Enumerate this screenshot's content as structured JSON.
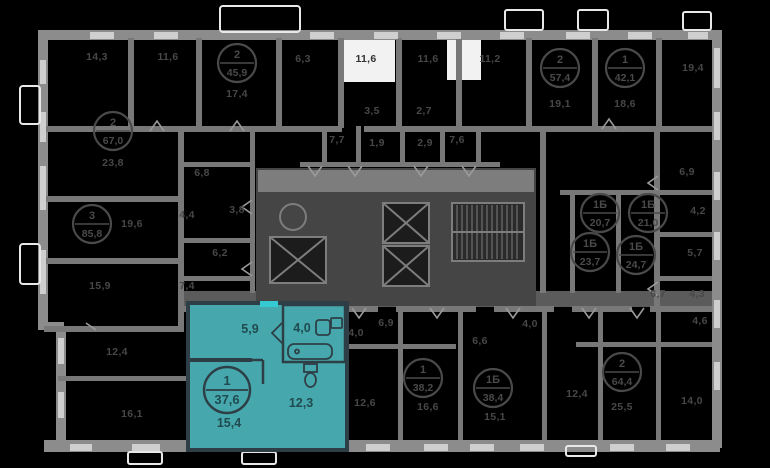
{
  "plan": {
    "colors": {
      "background": "#000000",
      "wall": "#8c8c8c",
      "window": "#cfcfcf",
      "corridor": "#5b5b5b",
      "core": "#454545",
      "white_room": "#f2f2f2",
      "dim_label": "#474747",
      "highlight_fill": "#46a8ac",
      "highlight_wall": "#2e3e46",
      "highlight_text": "#1f4b50",
      "entrance_mark": "#35c9d1"
    },
    "highlight": {
      "badge_rooms": "1",
      "badge_area": "37,6",
      "hall_area": "5,9",
      "bath_area": "4,0",
      "living_area": "15,4",
      "kitchen_area": "12,3"
    },
    "units": [
      {
        "rooms": "2",
        "area": "45,9",
        "x": 237,
        "y": 63
      },
      {
        "rooms": "2",
        "area": "67,0",
        "x": 113,
        "y": 131
      },
      {
        "rooms": "3",
        "area": "85,8",
        "x": 92,
        "y": 224
      },
      {
        "rooms": "2",
        "area": "57,4",
        "x": 560,
        "y": 68
      },
      {
        "rooms": "1",
        "area": "42,1",
        "x": 625,
        "y": 68
      },
      {
        "rooms": "1Б",
        "area": "20,7",
        "x": 600,
        "y": 213
      },
      {
        "rooms": "1Б",
        "area": "21,0",
        "x": 648,
        "y": 213
      },
      {
        "rooms": "1Б",
        "area": "23,7",
        "x": 590,
        "y": 252
      },
      {
        "rooms": "1Б",
        "area": "24,7",
        "x": 636,
        "y": 255
      },
      {
        "rooms": "1",
        "area": "38,2",
        "x": 423,
        "y": 378
      },
      {
        "rooms": "1Б",
        "area": "38,4",
        "x": 493,
        "y": 388
      },
      {
        "rooms": "2",
        "area": "64,4",
        "x": 622,
        "y": 372
      }
    ],
    "room_labels": [
      {
        "text": "14,3",
        "x": 97,
        "y": 60,
        "variant": "dim"
      },
      {
        "text": "11,6",
        "x": 168,
        "y": 60,
        "variant": "dim"
      },
      {
        "text": "17,4",
        "x": 237,
        "y": 97,
        "variant": "dim"
      },
      {
        "text": "6,3",
        "x": 303,
        "y": 62,
        "variant": "dim"
      },
      {
        "text": "11,6",
        "x": 366,
        "y": 62,
        "variant": "white"
      },
      {
        "text": "11,6",
        "x": 428,
        "y": 62,
        "variant": "dim"
      },
      {
        "text": "11,2",
        "x": 490,
        "y": 62,
        "variant": "dim"
      },
      {
        "text": "19,1",
        "x": 560,
        "y": 107,
        "variant": "dim"
      },
      {
        "text": "18,6",
        "x": 625,
        "y": 107,
        "variant": "dim"
      },
      {
        "text": "19,4",
        "x": 693,
        "y": 71,
        "variant": "dim"
      },
      {
        "text": "23,8",
        "x": 113,
        "y": 166,
        "variant": "dim"
      },
      {
        "text": "6,8",
        "x": 202,
        "y": 176,
        "variant": "dim"
      },
      {
        "text": "19,6",
        "x": 132,
        "y": 227,
        "variant": "dim"
      },
      {
        "text": "4,4",
        "x": 187,
        "y": 218,
        "variant": "dim"
      },
      {
        "text": "3,8",
        "x": 237,
        "y": 213,
        "variant": "dim"
      },
      {
        "text": "6,2",
        "x": 220,
        "y": 256,
        "variant": "dim"
      },
      {
        "text": "15,9",
        "x": 100,
        "y": 289,
        "variant": "dim"
      },
      {
        "text": "7,4",
        "x": 187,
        "y": 289,
        "variant": "dim"
      },
      {
        "text": "3,5",
        "x": 372,
        "y": 114,
        "variant": "dim"
      },
      {
        "text": "2,7",
        "x": 424,
        "y": 114,
        "variant": "dim"
      },
      {
        "text": "7,7",
        "x": 337,
        "y": 143,
        "variant": "dim"
      },
      {
        "text": "1,9",
        "x": 377,
        "y": 146,
        "variant": "dim"
      },
      {
        "text": "2,9",
        "x": 425,
        "y": 146,
        "variant": "dim"
      },
      {
        "text": "7,6",
        "x": 457,
        "y": 143,
        "variant": "dim"
      },
      {
        "text": "6,9",
        "x": 687,
        "y": 175,
        "variant": "dim"
      },
      {
        "text": "4,2",
        "x": 698,
        "y": 214,
        "variant": "dim"
      },
      {
        "text": "5,7",
        "x": 695,
        "y": 256,
        "variant": "dim"
      },
      {
        "text": "6,7",
        "x": 658,
        "y": 297,
        "variant": "dim"
      },
      {
        "text": "4,3",
        "x": 697,
        "y": 297,
        "variant": "dim"
      },
      {
        "text": "6,9",
        "x": 386,
        "y": 326,
        "variant": "dim"
      },
      {
        "text": "4,0",
        "x": 356,
        "y": 336,
        "variant": "dim"
      },
      {
        "text": "4,0",
        "x": 530,
        "y": 327,
        "variant": "dim"
      },
      {
        "text": "6,6",
        "x": 480,
        "y": 344,
        "variant": "dim"
      },
      {
        "text": "4,6",
        "x": 700,
        "y": 324,
        "variant": "dim"
      },
      {
        "text": "12,4",
        "x": 117,
        "y": 355,
        "variant": "dim"
      },
      {
        "text": "16,1",
        "x": 132,
        "y": 417,
        "variant": "dim"
      },
      {
        "text": "12,6",
        "x": 365,
        "y": 406,
        "variant": "dim"
      },
      {
        "text": "16,6",
        "x": 428,
        "y": 410,
        "variant": "dim"
      },
      {
        "text": "15,1",
        "x": 495,
        "y": 420,
        "variant": "dim"
      },
      {
        "text": "12,4",
        "x": 577,
        "y": 397,
        "variant": "dim"
      },
      {
        "text": "25,5",
        "x": 622,
        "y": 410,
        "variant": "dim"
      },
      {
        "text": "14,0",
        "x": 692,
        "y": 404,
        "variant": "dim"
      }
    ]
  }
}
